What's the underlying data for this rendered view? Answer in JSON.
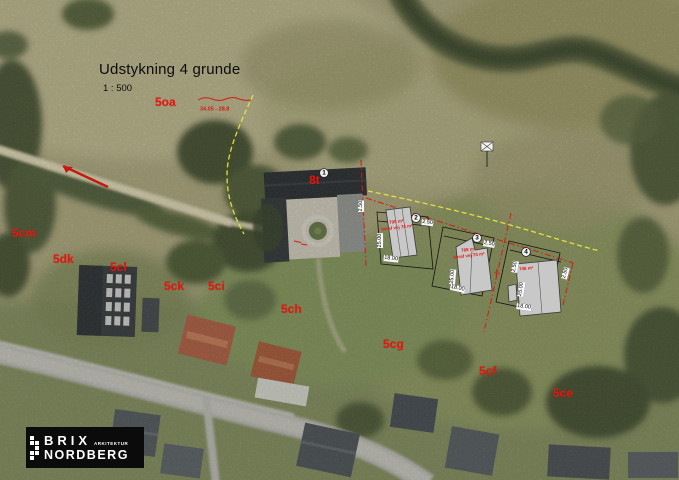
{
  "title": {
    "main": "Udstykning 4 grunde",
    "scale": "1 : 500"
  },
  "boundary_note": "34.05 - 28.8",
  "parcels": {
    "p5oa": "5oa",
    "p5cm": "5cm",
    "p5dk": "5dk",
    "p5cl": "5cl",
    "p5ck": "5ck",
    "p5ci": "5ci",
    "p5ch": "5ch",
    "p5cg": "5cg",
    "p5cf": "5cf",
    "p5ce": "5ce",
    "p8t": "8t"
  },
  "plots": {
    "n1": "1",
    "n2": "2",
    "n3": "3",
    "n4": "4",
    "plot2_area": "790 m²",
    "plot2_road": "heraf vej 74 m²",
    "plot3_area": "788 m²",
    "plot3_road": "heraf vej 74 m²",
    "plot4_area": "746 m²"
  },
  "dims": {
    "d0": "2.50",
    "d1": "2.50",
    "d2": "25.00",
    "d3": "18.00",
    "d4": "2.50",
    "d5": "25.00",
    "d6": "18.00",
    "d7": "2.50",
    "d8": "25.00",
    "d9": "2.50",
    "d10": "18.00"
  },
  "logo": {
    "top": "BRIX",
    "bottom": "NORDBERG",
    "tag": "ARKITEKTUR"
  },
  "colors": {
    "annotation_red": "#e8150d",
    "boundary_yellow": "#e9e63b",
    "building_fill": "#c8c8c8"
  }
}
